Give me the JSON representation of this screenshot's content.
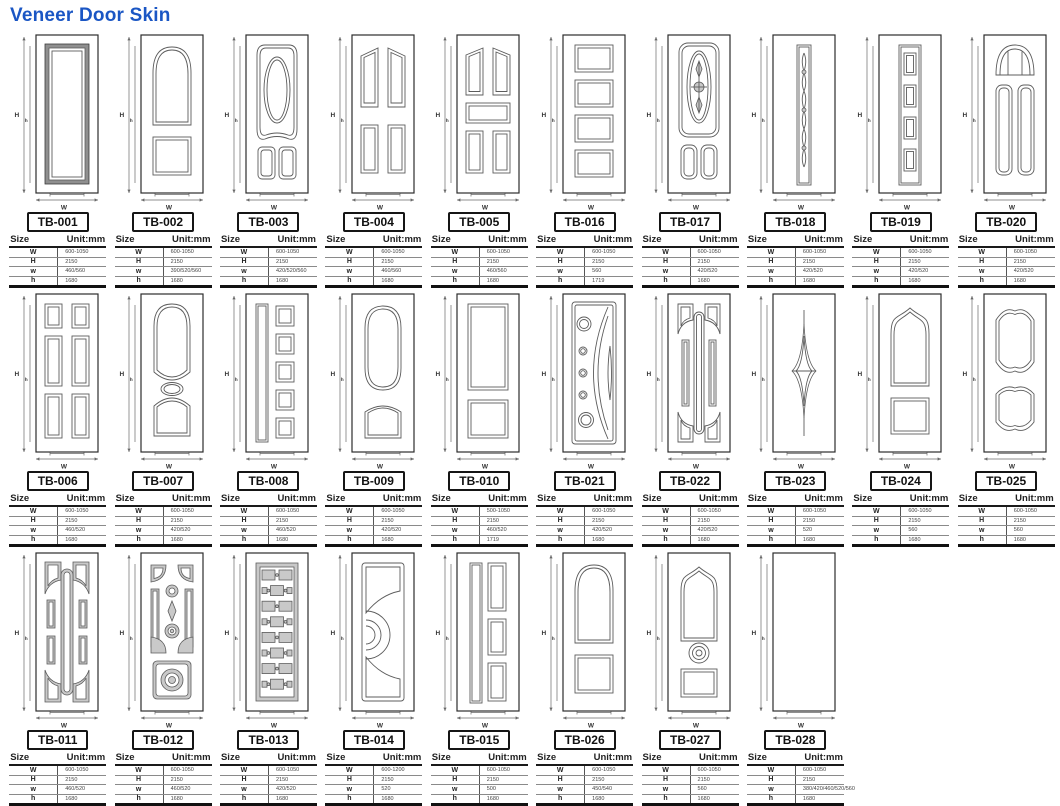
{
  "page": {
    "title": "Veneer Door Skin",
    "title_color": "#1a56c4",
    "background": "#ffffff"
  },
  "table_header": {
    "size_label": "Size",
    "unit_label": "Unit:mm"
  },
  "row_labels": [
    "W",
    "H",
    "w",
    "h"
  ],
  "dim_labels": {
    "H": "H",
    "h": "h",
    "W": "W",
    "w": "w"
  },
  "doors": [
    {
      "id": "TB-001",
      "row": 1,
      "design": "single-panel-dark",
      "dims": {
        "W": "600-1050",
        "H": "2150",
        "w": "460/560",
        "h": "1680"
      }
    },
    {
      "id": "TB-002",
      "row": 1,
      "design": "arch-top-two-panel",
      "dims": {
        "W": "600-1050",
        "H": "2150",
        "w": "390/520/560",
        "h": "1680"
      }
    },
    {
      "id": "TB-003",
      "row": 1,
      "design": "oval-center-two-bottom",
      "dims": {
        "W": "600-1050",
        "H": "2150",
        "w": "420/520/560",
        "h": "1680"
      }
    },
    {
      "id": "TB-004",
      "row": 1,
      "design": "four-panel",
      "dims": {
        "W": "600-1050",
        "H": "2150",
        "w": "460/560",
        "h": "1680"
      }
    },
    {
      "id": "TB-005",
      "row": 1,
      "design": "five-panel",
      "dims": {
        "W": "600-1050",
        "H": "2150",
        "w": "460/560",
        "h": "1680"
      }
    },
    {
      "id": "TB-016",
      "row": 1,
      "design": "four-window-stack",
      "dims": {
        "W": "600-1050",
        "H": "2150",
        "w": "560",
        "h": "1719"
      }
    },
    {
      "id": "TB-017",
      "row": 1,
      "design": "ornate-oval-two-arch",
      "dims": {
        "W": "600-1050",
        "H": "2150",
        "w": "420/520",
        "h": "1680"
      }
    },
    {
      "id": "TB-018",
      "row": 1,
      "design": "braid-strip",
      "dims": {
        "W": "600-1050",
        "H": "2150",
        "w": "420/520",
        "h": "1680"
      }
    },
    {
      "id": "TB-019",
      "row": 1,
      "design": "square-stack-strip",
      "dims": {
        "W": "600-1050",
        "H": "2150",
        "w": "420/520",
        "h": "1680"
      }
    },
    {
      "id": "TB-020",
      "row": 1,
      "design": "fan-top-two-panel",
      "dims": {
        "W": "600-1050",
        "H": "2150",
        "w": "420/520",
        "h": "1680"
      }
    },
    {
      "id": "TB-006",
      "row": 2,
      "design": "six-panel",
      "dims": {
        "W": "600-1050",
        "H": "2150",
        "w": "460/520",
        "h": "1680"
      }
    },
    {
      "id": "TB-007",
      "row": 2,
      "design": "arch-oval-bottom",
      "dims": {
        "W": "600-1050",
        "H": "2150",
        "w": "420/520",
        "h": "1680"
      }
    },
    {
      "id": "TB-008",
      "row": 2,
      "design": "strip-five-squares",
      "dims": {
        "W": "600-1050",
        "H": "2150",
        "w": "460/520",
        "h": "1680"
      }
    },
    {
      "id": "TB-009",
      "row": 2,
      "design": "rounded-arch-two-panel",
      "dims": {
        "W": "600-1050",
        "H": "2150",
        "w": "420/520",
        "h": "1680"
      }
    },
    {
      "id": "TB-010",
      "row": 2,
      "design": "two-panel",
      "dims": {
        "W": "500-1050",
        "H": "2150",
        "w": "460/520",
        "h": "1719"
      }
    },
    {
      "id": "TB-021",
      "row": 2,
      "design": "circles-crescent",
      "dims": {
        "W": "600-1050",
        "H": "2150",
        "w": "420/520",
        "h": "1680"
      }
    },
    {
      "id": "TB-022",
      "row": 2,
      "design": "capsule-corner-panels",
      "dims": {
        "W": "600-1050",
        "H": "2150",
        "w": "420/520",
        "h": "1680"
      }
    },
    {
      "id": "TB-023",
      "row": 2,
      "design": "star-ornament",
      "dims": {
        "W": "600-1050",
        "H": "2150",
        "w": "520",
        "h": "1680"
      }
    },
    {
      "id": "TB-024",
      "row": 2,
      "design": "ogee-arch-two-panel",
      "dims": {
        "W": "600-1050",
        "H": "2150",
        "w": "560",
        "h": "1680"
      }
    },
    {
      "id": "TB-025",
      "row": 2,
      "design": "double-curve-panels",
      "dims": {
        "W": "600-1050",
        "H": "2150",
        "w": "560",
        "h": "1680"
      }
    },
    {
      "id": "TB-011",
      "row": 3,
      "design": "capsule-grid",
      "dims": {
        "W": "600-1050",
        "H": "2150",
        "w": "460/520",
        "h": "1680"
      }
    },
    {
      "id": "TB-012",
      "row": 3,
      "design": "ornate-maze",
      "dims": {
        "W": "600-1050",
        "H": "2150",
        "w": "460/520",
        "h": "1680"
      }
    },
    {
      "id": "TB-013",
      "row": 3,
      "design": "brick-pattern",
      "dims": {
        "W": "600-1050",
        "H": "2150",
        "w": "420/520",
        "h": "1680"
      }
    },
    {
      "id": "TB-014",
      "row": 3,
      "design": "fan-curve",
      "dims": {
        "W": "600-1200",
        "H": "2150",
        "w": "520",
        "h": "1680"
      }
    },
    {
      "id": "TB-015",
      "row": 3,
      "design": "strip-three-rects",
      "dims": {
        "W": "600-1050",
        "H": "2150",
        "w": "500",
        "h": "1680"
      }
    },
    {
      "id": "TB-026",
      "row": 3,
      "design": "arch-top-two-panel",
      "dims": {
        "W": "600-1050",
        "H": "2150",
        "w": "450/540",
        "h": "1680"
      }
    },
    {
      "id": "TB-027",
      "row": 3,
      "design": "ogee-rosette-two-panel",
      "dims": {
        "W": "600-1050",
        "H": "2150",
        "w": "560",
        "h": "1680"
      }
    },
    {
      "id": "TB-028",
      "row": 3,
      "design": "plain",
      "dims": {
        "W": "600-1050",
        "H": "2150",
        "w": "380/420/460/520/560",
        "h": "1680"
      }
    }
  ]
}
